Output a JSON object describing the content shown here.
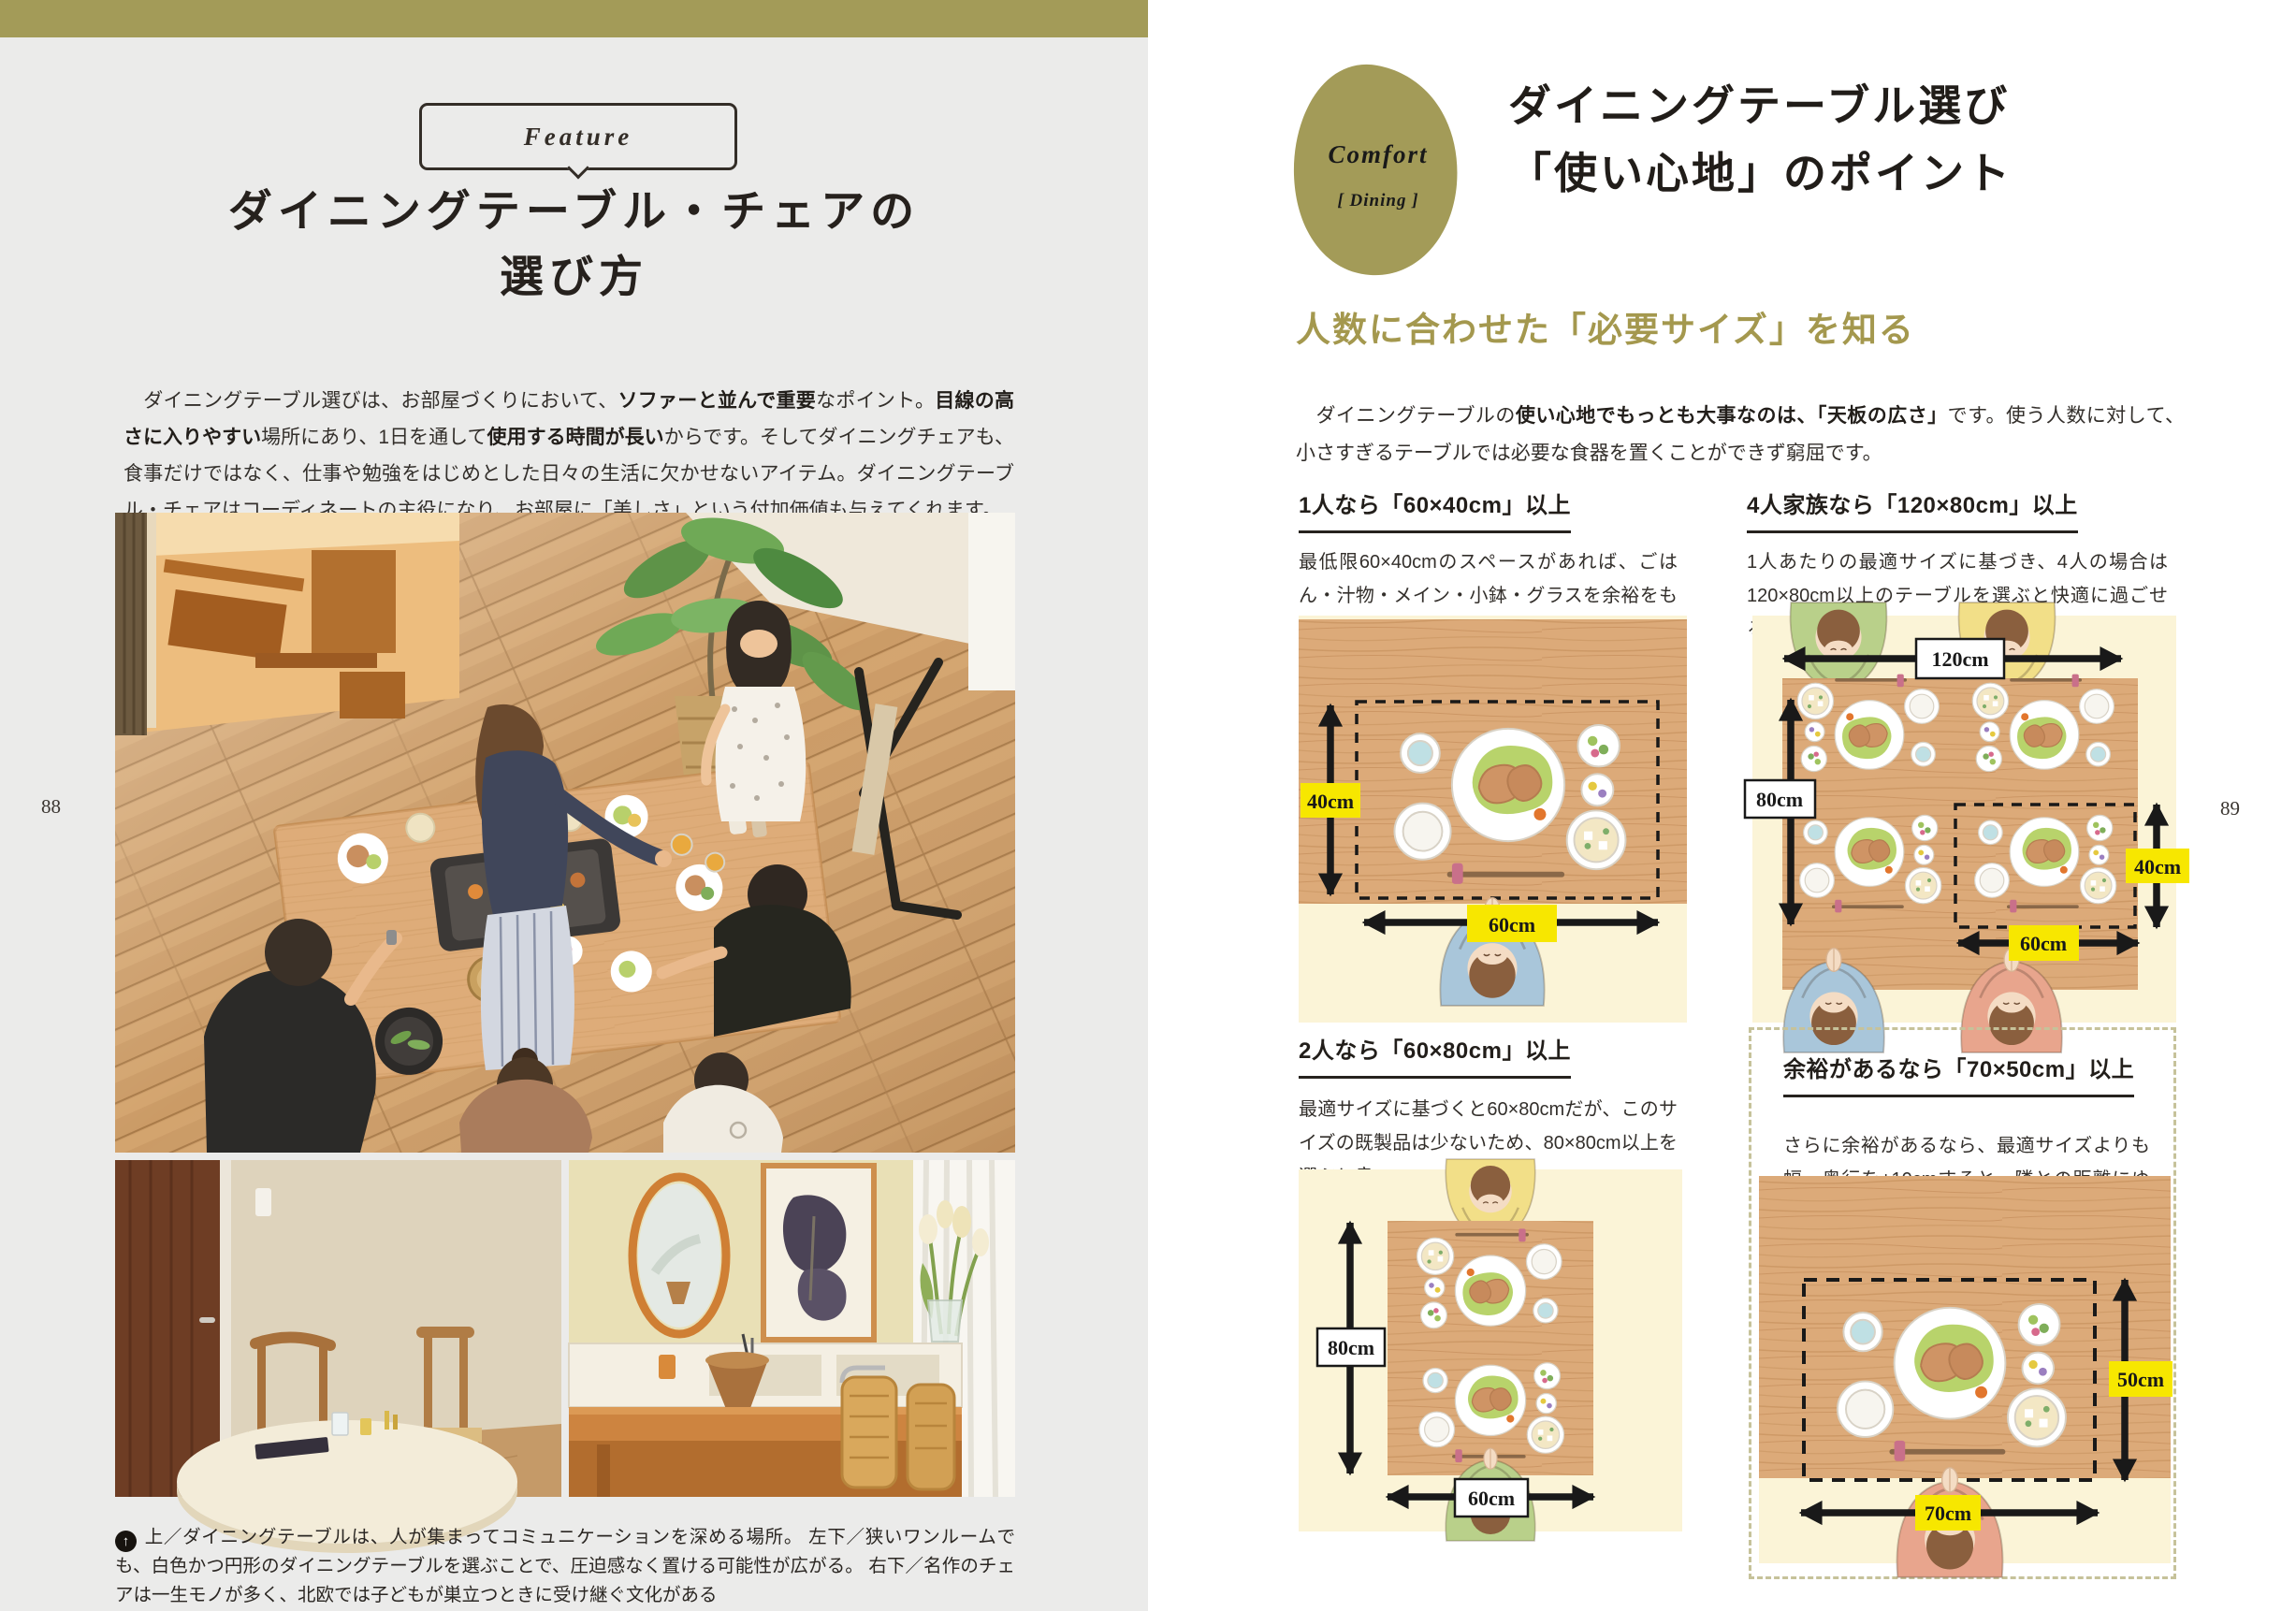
{
  "accent": {
    "olive": "#a39b58",
    "subtitle_green": "#a4984e",
    "label_yellow": "#f7e700",
    "diagram_bg": "#fbf4d7"
  },
  "page_left": {
    "page_number": "88",
    "feature_label": "Feature",
    "title_lines": [
      "ダイニングテーブル・チェアの",
      "選び方"
    ],
    "intro_segments": [
      {
        "t": "　ダイニングテーブル選びは、お部屋づくりにおいて、",
        "b": false
      },
      {
        "t": "ソファーと並んで重要",
        "b": true
      },
      {
        "t": "なポイント。",
        "b": false
      },
      {
        "t": "目線の高さに入りやすい",
        "b": true
      },
      {
        "t": "場所にあり、1日を通して",
        "b": false
      },
      {
        "t": "使用する時間が長い",
        "b": true
      },
      {
        "t": "からです。そしてダイニングチェアも、食事だけではなく、仕事や勉強をはじめとした日々の生活に欠かせないアイテム。ダイニングテーブル・チェアはコーディネートの主役になり、お部屋に「美しさ」という付加価値も与えてくれます。",
        "b": false
      }
    ],
    "caption_marker": "↑",
    "caption_text": "上／ダイニングテーブルは、人が集まってコミュニケーションを深める場所。 左下／狭いワンルームでも、白色かつ円形のダイニングテーブルを選ぶことで、圧迫感なく置ける可能性が広がる。 右下／名作のチェアは一生モノが多く、北欧では子どもが巣立つときに受け継ぐ文化がある",
    "photos": {
      "main_alt": "overhead-family-dining-photo",
      "bottom_left_alt": "round-white-table-photo",
      "bottom_right_alt": "designer-chairs-interior-photo"
    }
  },
  "page_right": {
    "page_number": "89",
    "badge": {
      "title": "Comfort",
      "subtitle": "[ Dining ]"
    },
    "title_lines": [
      "ダイニングテーブル選び",
      "「使い心地」のポイント"
    ],
    "lead_heading": "人数に合わせた「必要サイズ」を知る",
    "intro_segments": [
      {
        "t": "　ダイニングテーブルの",
        "b": false
      },
      {
        "t": "使い心地でもっとも大事なのは、「天板の広さ」",
        "b": true
      },
      {
        "t": "です。使う人数に対して、小さすぎるテーブルでは必要な食器を置くことができず窮屈です。",
        "b": false
      }
    ],
    "sections": [
      {
        "heading": "1人なら「60×40cm」以上",
        "body": "最低限60×40cmのスペースがあれば、ごはん・汁物・メイン・小鉢・グラスを余裕をもって配置できる。",
        "labels": {
          "depth": "40cm",
          "width": "60cm"
        }
      },
      {
        "heading": "4人家族なら「120×80cm」以上",
        "body": "1人あたりの最適サイズに基づき、4人の場合は120×80cm以上のテーブルを選ぶと快適に過ごせる。",
        "labels": {
          "table_width": "120cm",
          "table_depth": "80cm",
          "width": "60cm",
          "depth": "40cm"
        }
      },
      {
        "heading": "2人なら「60×80cm」以上",
        "body": "最適サイズに基づくと60×80cmだが、このサイズの既製品は少ないため、80×80cm以上を選ぶと良い。",
        "labels": {
          "depth": "80cm",
          "width": "60cm"
        }
      },
      {
        "heading": "余裕があるなら「70×50cm」以上",
        "body": "さらに余裕があるなら、最適サイズよりも幅・奥行を+10cmすると、隣との距離にゆとりが生まれる。",
        "labels": {
          "width": "70cm",
          "depth": "50cm"
        }
      }
    ]
  }
}
